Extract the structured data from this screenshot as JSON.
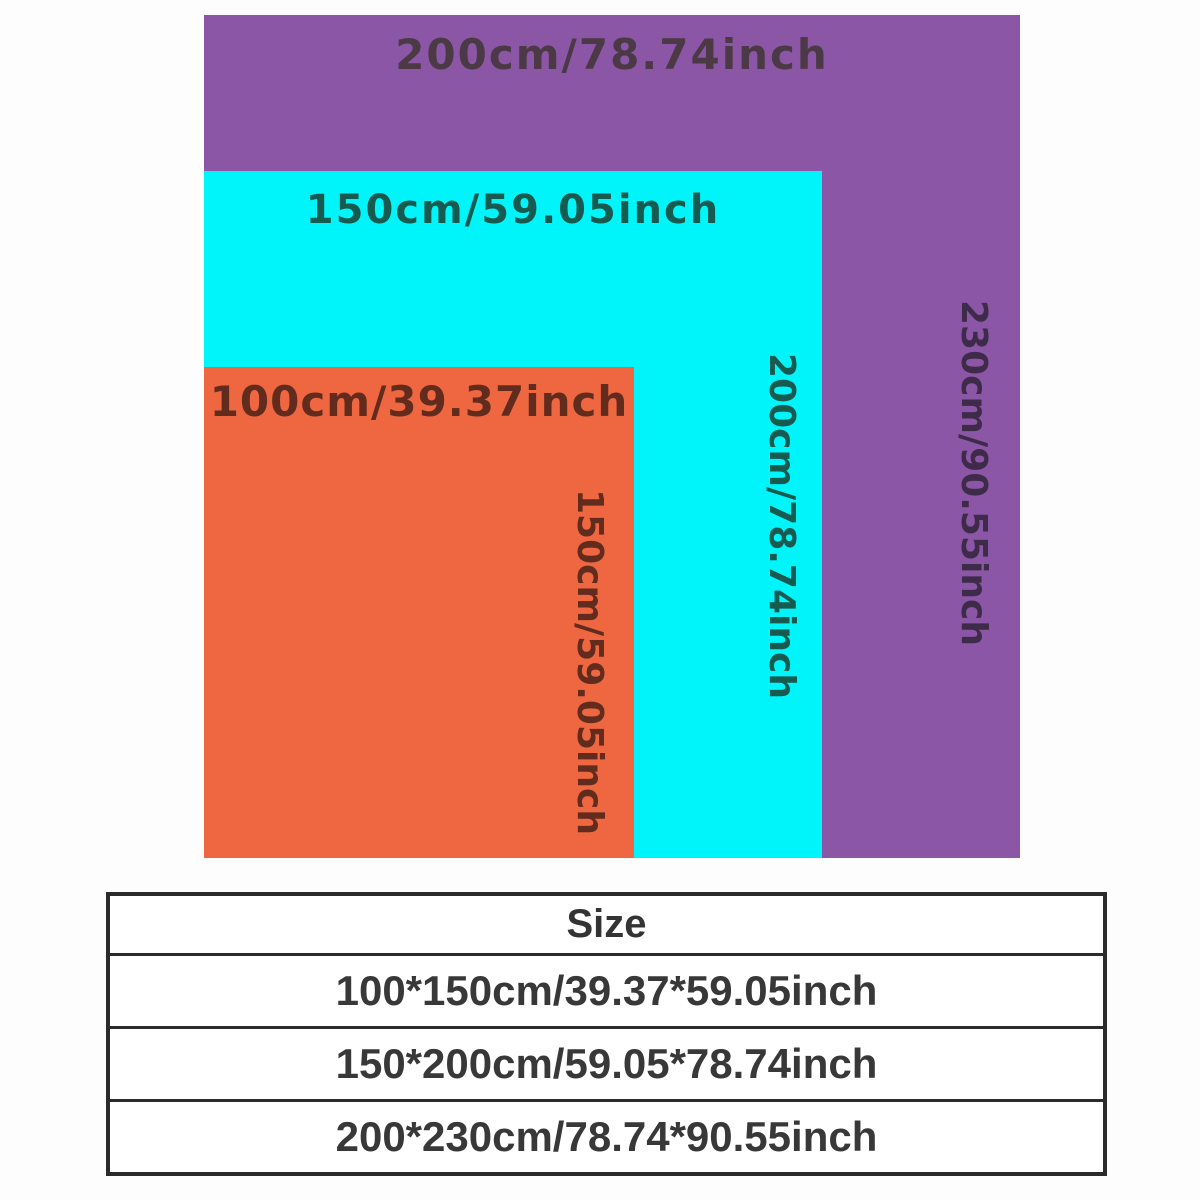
{
  "diagram": {
    "title": "blanket-size-comparison",
    "sizes": [
      {
        "id": "small",
        "rect_color": "#ee6740",
        "label_color": "#612b1d",
        "width_label": "100cm/39.37inch",
        "height_label": "150cm/59.05inch"
      },
      {
        "id": "medium",
        "rect_color": "#00f5fa",
        "label_color": "#175a50",
        "width_label": "150cm/59.05inch",
        "height_label": "200cm/78.74inch"
      },
      {
        "id": "large",
        "rect_color": "#8a56a5",
        "width_label_color": "#4b3a45",
        "height_label_color": "#3e2b49",
        "width_label": "200cm/78.74inch",
        "height_label": "230cm/90.55inch"
      }
    ]
  },
  "table": {
    "header": "Size",
    "border_color": "#2b2b2b",
    "text_color": "#383838",
    "rows": [
      {
        "size": "100*150cm/39.37*59.05inch"
      },
      {
        "size": "150*200cm/59.05*78.74inch"
      },
      {
        "size": "200*230cm/78.74*90.55inch"
      }
    ]
  }
}
